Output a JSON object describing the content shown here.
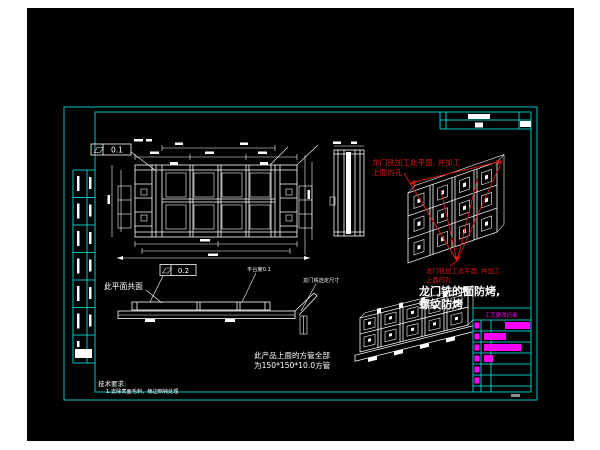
{
  "colors": {
    "background": "#ffffff",
    "canvas": "#000000",
    "frame": "#00c2c2",
    "line": "#ffffff",
    "red": "#d31717",
    "magenta": "#ff00ff"
  },
  "labels": {
    "coplanar": "此平面共面",
    "platform_flatness": "平台度0.1",
    "gantry_dim": "龙门铣选定尺寸",
    "gdt_top_value": "0.1",
    "gdt_mid_value": "0.2",
    "red_note_a1": "龙门铣加工此平面, 并加工",
    "red_note_a2": "上面的孔",
    "red_note_b1": "龙门铣加工此平面, 并加工",
    "red_note_b2": "上面的孔",
    "mask1": "龙门铣的面防烤,",
    "mask2": "螺纹防烤",
    "tube1": "此产品上面的方管全部",
    "tube2": "为150*150*10.0方管",
    "tech_title": "技术要求:",
    "tech_item": "1.去除表面毛刺，棱边倒钝处理",
    "rev_header": "工艺更改记录"
  }
}
